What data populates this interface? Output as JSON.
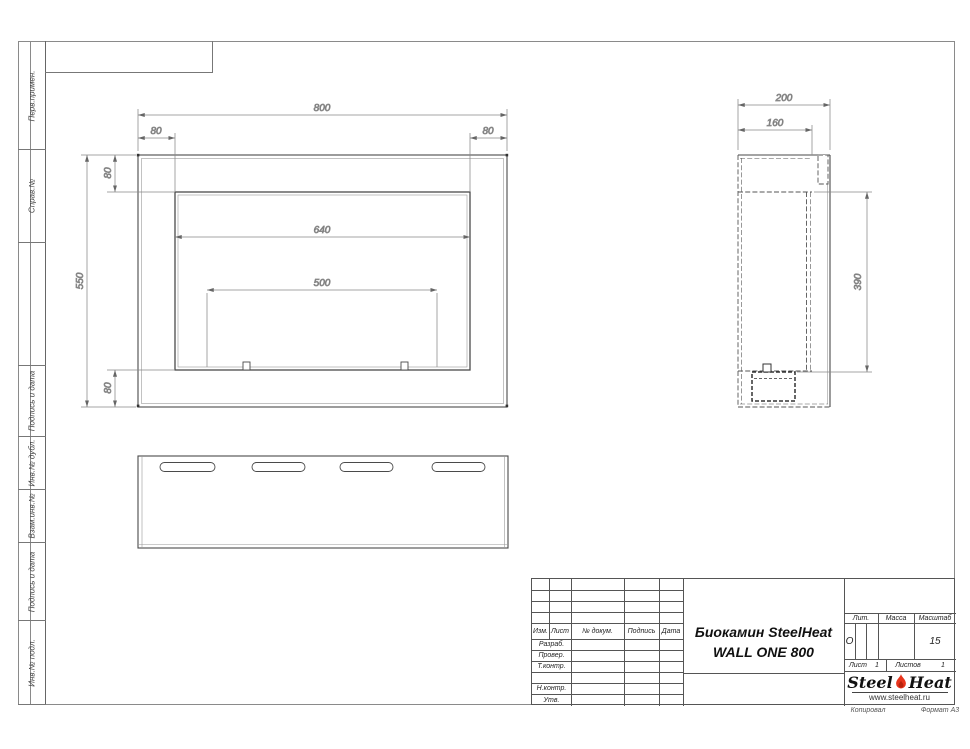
{
  "sidebar": {
    "cells": [
      "Перв.примен.",
      "Справ.№",
      "Подпись и дата",
      "Инв.№ дубл.",
      "Взам.инв.№",
      "Подпись и дата",
      "Инв.№ подл."
    ]
  },
  "drawing": {
    "front": {
      "d800": "800",
      "d80l": "80",
      "d80r": "80",
      "d80t": "80",
      "d80b": "80",
      "d550": "550",
      "d640": "640",
      "d500": "500"
    },
    "side": {
      "d200": "200",
      "d160": "160",
      "d390": "390"
    }
  },
  "title_block": {
    "rev_header": {
      "izm": "Изм.",
      "list": "Лист",
      "doc": "№ докум.",
      "sign": "Подпись",
      "date": "Дата"
    },
    "sig_rows": {
      "razrab": "Разраб.",
      "prover": "Провер.",
      "tkontr": "Т.контр.",
      "nkontr": "Н.контр.",
      "utv": "Утв."
    },
    "title_line1": "Биокамин SteelHeat",
    "title_line2": "WALL ONE 800",
    "lit_label": "Лит.",
    "lit_value": "О",
    "mass_label": "Масса",
    "scale_label": "Масштаб",
    "scale_value": "15",
    "sheet_label": "Лист",
    "sheet_value": "1",
    "sheets_label": "Листов",
    "sheets_value": "1",
    "logo": {
      "word1": "Steel",
      "word2": "Heat",
      "url": "www.steelheat.ru",
      "flame_color": "#e8341c"
    }
  },
  "footer": {
    "copied": "Копировал",
    "format": "Формат А3"
  }
}
